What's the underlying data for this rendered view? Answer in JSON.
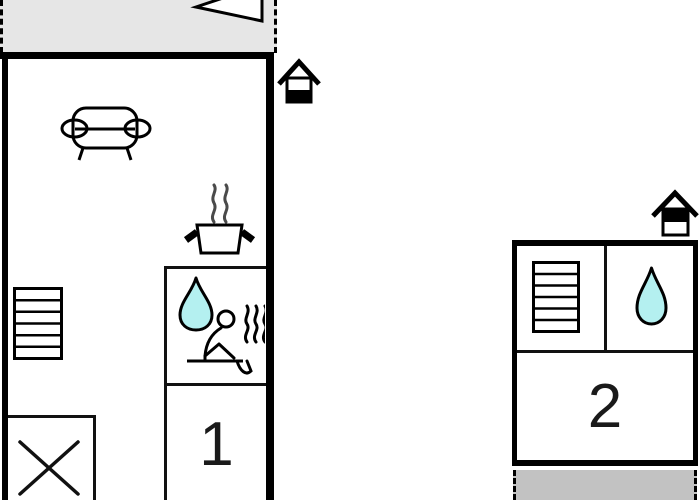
{
  "document": {
    "type": "floor-plan",
    "background": "#ffffff"
  },
  "colors": {
    "wall": "#000000",
    "water": "#b4f0f0",
    "steam": "#4a4a4a",
    "terrace_top_fill": "#e6e6e6",
    "terrace_bottom_fill": "#c2c2c2",
    "icon_fill": "#ffffff"
  },
  "units": [
    {
      "label": "1",
      "floor_indicator_icon": "house glyph, lower half filled (ground floor)",
      "icons_present": [
        "sofa-icon",
        "cooking-pot-steam-icon",
        "water-drop-icon",
        "sauna-person-icon",
        "stairs-icon",
        "cross-icon",
        "direction-arrow-icon"
      ],
      "terrace": "gray dashed area at top with cropped triangle arrow"
    },
    {
      "label": "2",
      "floor_indicator_icon": "house glyph, upper half filled (upper floor)",
      "icons_present": [
        "stairs-icon",
        "water-drop-icon"
      ],
      "terrace": "gray dashed strip below unit"
    }
  ],
  "icons": {
    "sofa-icon": "sofa seen from front (living area)",
    "cooking-pot-steam-icon": "pot with two steam curls (kitchen)",
    "water-drop-icon": "teardrop (shower/bath)",
    "sauna-person-icon": "seated person on bench with heat waves (sauna)",
    "stairs-icon": "staircase, 6 treads",
    "cross-icon": "X-marked square area",
    "house-ground-floor-icon": "small house, bottom half black",
    "house-upper-floor-icon": "small house, top half black",
    "direction-arrow-icon": "white triangle pointing left, cropped at top edge"
  }
}
